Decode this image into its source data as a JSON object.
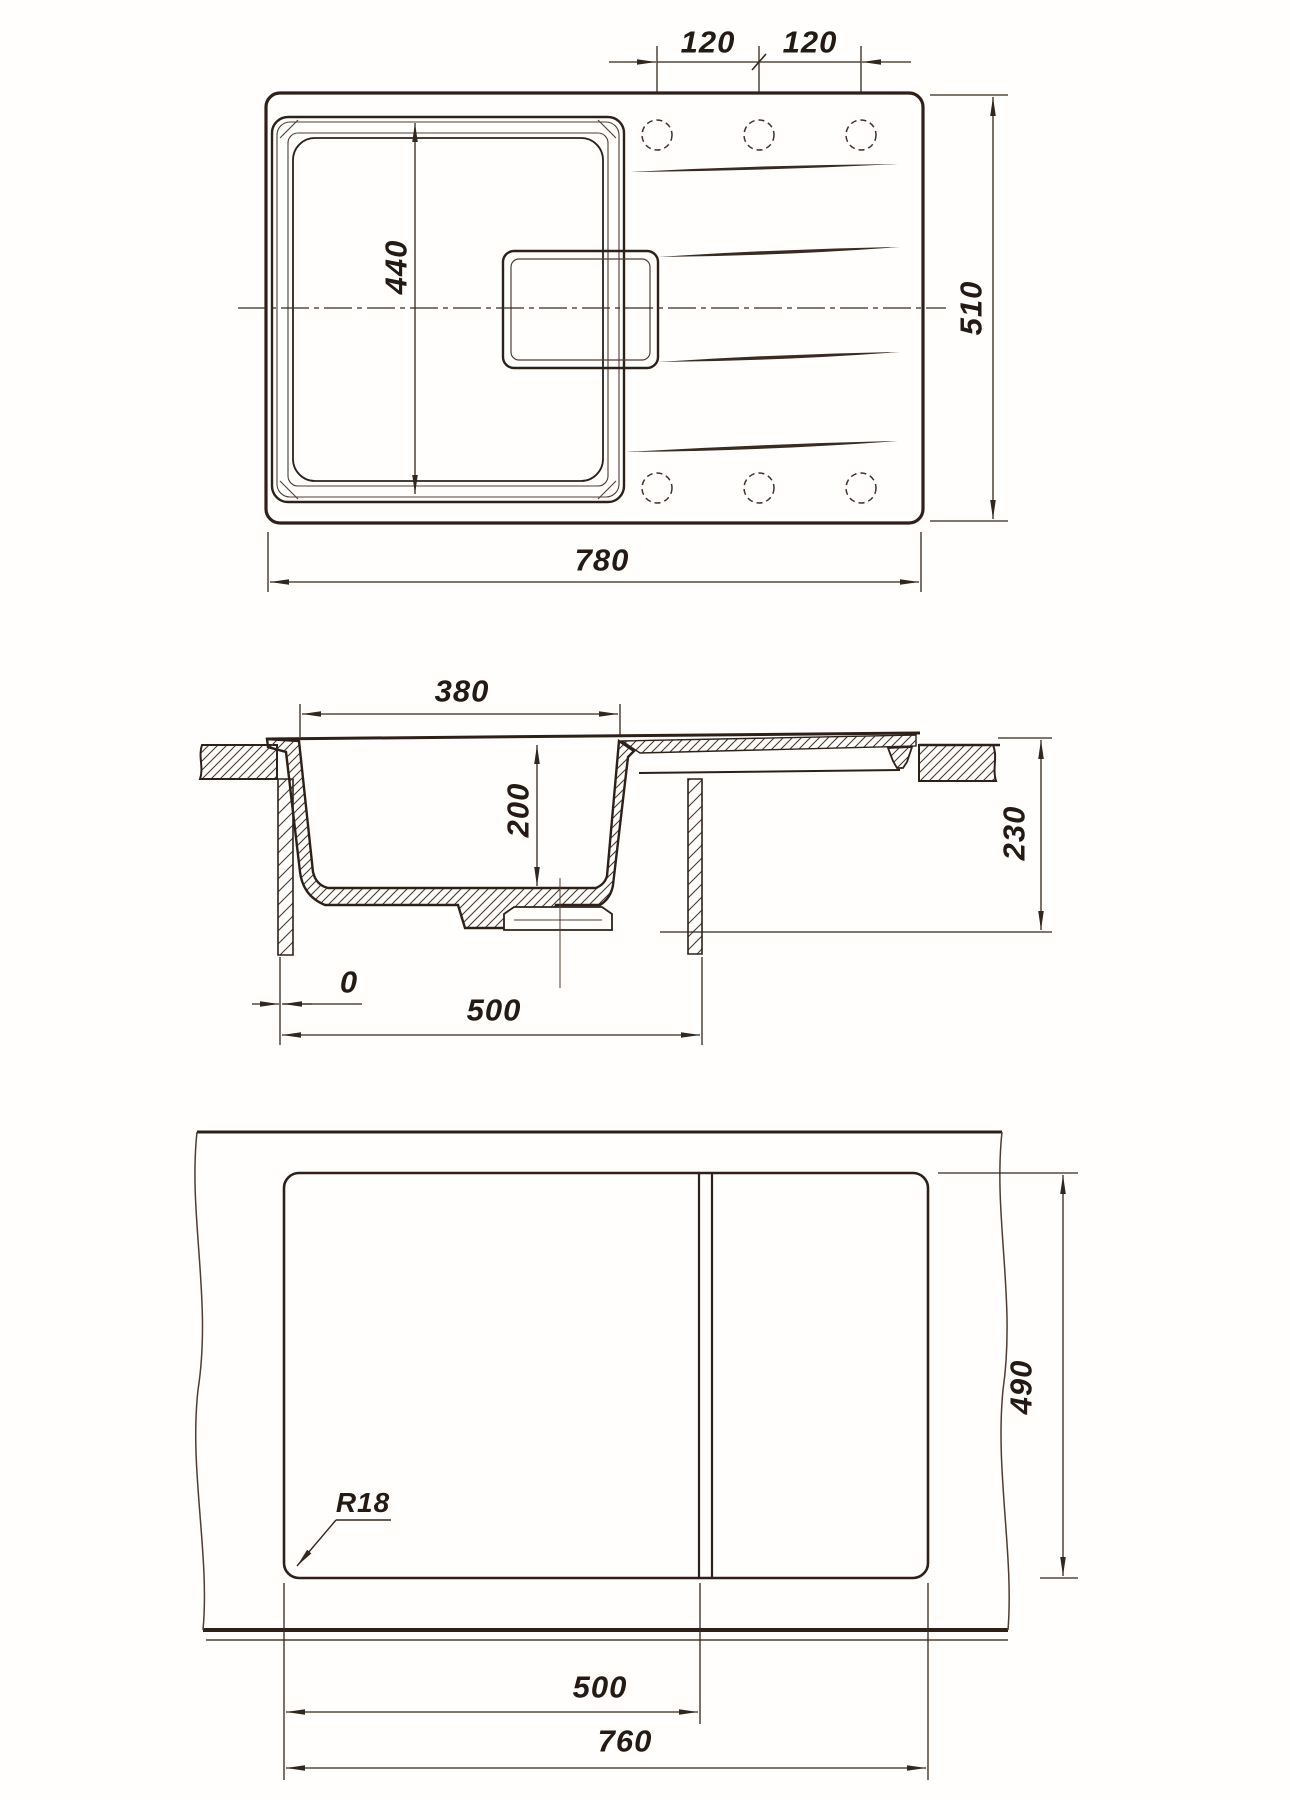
{
  "views": {
    "top": {
      "hole_pitch_left": "120",
      "hole_pitch_right": "120",
      "overall_length": "780",
      "overall_width": "510",
      "bowl_length": "440"
    },
    "section": {
      "bowl_width": "380",
      "bowl_depth": "200",
      "overall_height": "230",
      "zero_offset": "0",
      "cabinet_width": "500"
    },
    "cutout": {
      "left_section": "500",
      "cutout_length": "760",
      "cutout_depth": "490",
      "corner_radius": "R18"
    }
  }
}
